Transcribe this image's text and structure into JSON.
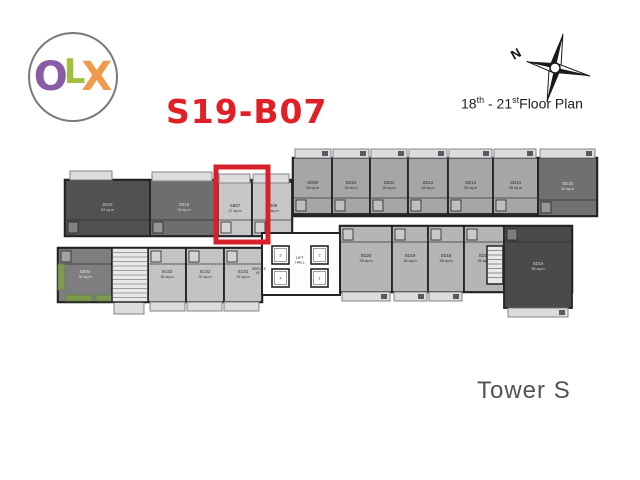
{
  "logo": {
    "letters": [
      {
        "ch": "O",
        "color": "#8a5ba6"
      },
      {
        "ch": "L",
        "color": "#a2c03c"
      },
      {
        "ch": "X",
        "color": "#f09a4b"
      }
    ]
  },
  "header": {
    "unit_code": "S19-B07",
    "unit_code_color": "#e01f26",
    "compass_n": "N",
    "floor_label": {
      "num1": "18",
      "sup1": "th",
      "sep": " - ",
      "num2": "21",
      "sup2": "st",
      "rest": "Floor Plan"
    }
  },
  "footer": {
    "tower": "Tower S",
    "color": "#515256"
  },
  "plan": {
    "wall": "#232325",
    "balcony_fill": "#dcdcde",
    "balcony_stroke": "#85858a",
    "ac_fill": "#5a5a5e",
    "planter_color": "#7d9b50",
    "highlight": {
      "x": 216,
      "y": 167,
      "w": 52,
      "h": 75,
      "color": "#d8202a",
      "stroke": 5
    },
    "bands": [
      {
        "x": 65,
        "y": 180,
        "w": 227,
        "h": 56,
        "fill": "#9a9a9c"
      },
      {
        "x": 293,
        "y": 158,
        "w": 304,
        "h": 58,
        "fill": "#a9a9ab"
      },
      {
        "x": 58,
        "y": 248,
        "w": 204,
        "h": 54,
        "fill": "#bdbdbf"
      },
      {
        "x": 340,
        "y": 226,
        "w": 232,
        "h": 66,
        "fill": "#b3b3b5"
      }
    ],
    "units": [
      {
        "id": "S016",
        "area": "54 sq.m",
        "x": 65,
        "y": 180,
        "w": 85,
        "h": 56,
        "fill": "#515154",
        "tc": "#d2d2d2",
        "b": "tl"
      },
      {
        "id": "S018",
        "area": "34 sq.m",
        "x": 150,
        "y": 180,
        "w": 68,
        "h": 56,
        "fill": "#6e6e71",
        "tc": "#dedede",
        "b": "tl"
      },
      {
        "id": "SB07",
        "area": "27 sq.m",
        "x": 218,
        "y": 182,
        "w": 34,
        "h": 54,
        "fill": "#c7c7c9",
        "tc": "#2e2e2e",
        "b": "tl"
      },
      {
        "id": "SB08",
        "area": "27 sq.m",
        "x": 252,
        "y": 182,
        "w": 40,
        "h": 54,
        "fill": "#c7c7c9",
        "tc": "#2e2e2e",
        "b": "tl"
      },
      {
        "id": "SD09",
        "area": "26 sq.m",
        "x": 293,
        "y": 158,
        "w": 39,
        "h": 56,
        "fill": "#a6a6a8",
        "tc": "#28282c",
        "b": "tr"
      },
      {
        "id": "SD10",
        "area": "26 sq.m",
        "x": 332,
        "y": 158,
        "w": 38,
        "h": 56,
        "fill": "#a6a6a8",
        "tc": "#28282c",
        "b": "tr"
      },
      {
        "id": "SD11",
        "area": "26 sq.m",
        "x": 370,
        "y": 158,
        "w": 38,
        "h": 56,
        "fill": "#a6a6a8",
        "tc": "#28282c",
        "b": "tr"
      },
      {
        "id": "SD12",
        "area": "26 sq.m",
        "x": 408,
        "y": 158,
        "w": 40,
        "h": 56,
        "fill": "#a6a6a8",
        "tc": "#28282c",
        "b": "tr"
      },
      {
        "id": "SD13",
        "area": "26 sq.m",
        "x": 448,
        "y": 158,
        "w": 45,
        "h": 56,
        "fill": "#a6a6a8",
        "tc": "#28282c",
        "b": "tr"
      },
      {
        "id": "SD14",
        "area": "26 sq.m",
        "x": 493,
        "y": 158,
        "w": 45,
        "h": 56,
        "fill": "#a6a6a8",
        "tc": "#28282c",
        "b": "tr"
      },
      {
        "id": "SD15",
        "area": "34 sq.m",
        "x": 538,
        "y": 158,
        "w": 59,
        "h": 58,
        "fill": "#707073",
        "tc": "#e6e6e6",
        "b": "tr"
      },
      {
        "id": "SE04",
        "area": "34 sq.m",
        "x": 58,
        "y": 248,
        "w": 54,
        "h": 54,
        "fill": "#7e7e81",
        "tc": "#e6e6e6",
        "b": "bl"
      },
      {
        "id": "SC03",
        "area": "36 sq.m",
        "x": 148,
        "y": 248,
        "w": 38,
        "h": 54,
        "fill": "#c3c3c5",
        "tc": "#2e2e2e",
        "b": "bl"
      },
      {
        "id": "SC02",
        "area": "32 sq.m",
        "x": 186,
        "y": 248,
        "w": 38,
        "h": 54,
        "fill": "#c3c3c5",
        "tc": "#2e2e2e",
        "b": "bl"
      },
      {
        "id": "SC01",
        "area": "32 sq.m",
        "x": 224,
        "y": 248,
        "w": 38,
        "h": 54,
        "fill": "#c3c3c5",
        "tc": "#2e2e2e",
        "b": "bl"
      },
      {
        "id": "SD20",
        "area": "26 sq.m",
        "x": 340,
        "y": 226,
        "w": 52,
        "h": 66,
        "fill": "#b5b5b7",
        "tc": "#28282c",
        "b": "br"
      },
      {
        "id": "SD19",
        "area": "26 sq.m",
        "x": 392,
        "y": 226,
        "w": 36,
        "h": 66,
        "fill": "#b5b5b7",
        "tc": "#28282c",
        "b": "br"
      },
      {
        "id": "SD18",
        "area": "26 sq.m",
        "x": 428,
        "y": 226,
        "w": 36,
        "h": 66,
        "fill": "#b5b5b7",
        "tc": "#28282c",
        "b": "br"
      },
      {
        "id": "SD17",
        "area": "26 sq.m",
        "x": 464,
        "y": 226,
        "w": 40,
        "h": 66,
        "fill": "#b5b5b7",
        "tc": "#28282c",
        "b": "br"
      },
      {
        "id": "SD16",
        "area": "55 sq.m",
        "x": 504,
        "y": 226,
        "w": 68,
        "h": 82,
        "fill": "#4a4a4d",
        "tc": "#d6d6d6",
        "b": "br"
      }
    ],
    "balconies": [
      {
        "x": 70,
        "y": 171,
        "w": 42,
        "h": 9,
        "ac": false
      },
      {
        "x": 152,
        "y": 172,
        "w": 60,
        "h": 9,
        "ac": false
      },
      {
        "x": 219,
        "y": 174,
        "w": 31,
        "h": 9,
        "ac": false
      },
      {
        "x": 253,
        "y": 174,
        "w": 36,
        "h": 9,
        "ac": false
      },
      {
        "x": 295,
        "y": 149,
        "w": 36,
        "h": 9,
        "ac": true
      },
      {
        "x": 333,
        "y": 149,
        "w": 36,
        "h": 9,
        "ac": true
      },
      {
        "x": 371,
        "y": 149,
        "w": 36,
        "h": 9,
        "ac": true
      },
      {
        "x": 409,
        "y": 149,
        "w": 38,
        "h": 9,
        "ac": true
      },
      {
        "x": 449,
        "y": 149,
        "w": 43,
        "h": 9,
        "ac": true
      },
      {
        "x": 494,
        "y": 149,
        "w": 42,
        "h": 9,
        "ac": true
      },
      {
        "x": 540,
        "y": 149,
        "w": 55,
        "h": 9,
        "ac": true
      },
      {
        "x": 114,
        "y": 302,
        "w": 30,
        "h": 12,
        "ac": false
      },
      {
        "x": 150,
        "y": 302,
        "w": 35,
        "h": 9,
        "ac": false
      },
      {
        "x": 187,
        "y": 302,
        "w": 35,
        "h": 9,
        "ac": false
      },
      {
        "x": 224,
        "y": 302,
        "w": 35,
        "h": 9,
        "ac": false
      },
      {
        "x": 342,
        "y": 292,
        "w": 48,
        "h": 9,
        "ac": true
      },
      {
        "x": 394,
        "y": 292,
        "w": 33,
        "h": 9,
        "ac": true
      },
      {
        "x": 429,
        "y": 292,
        "w": 33,
        "h": 9,
        "ac": true
      },
      {
        "x": 508,
        "y": 308,
        "w": 60,
        "h": 9,
        "ac": true
      }
    ],
    "planters": [
      {
        "x": 58,
        "y": 264,
        "w": 7,
        "h": 26
      },
      {
        "x": 66,
        "y": 295,
        "w": 26,
        "h": 6
      },
      {
        "x": 96,
        "y": 295,
        "w": 16,
        "h": 6
      }
    ],
    "stairs": [
      {
        "x": 112,
        "y": 248,
        "w": 36,
        "h": 54
      },
      {
        "x": 487,
        "y": 246,
        "w": 16,
        "h": 38
      }
    ],
    "lift_lobby": {
      "x": 262,
      "y": 233,
      "w": 78,
      "h": 62
    },
    "lifts": [
      {
        "n": "3",
        "x": 272,
        "y": 246,
        "w": 17,
        "h": 18
      },
      {
        "n": "2",
        "x": 311,
        "y": 246,
        "w": 17,
        "h": 18
      },
      {
        "n": "4",
        "x": 272,
        "y": 269,
        "w": 17,
        "h": 18
      },
      {
        "n": "1",
        "x": 311,
        "y": 269,
        "w": 17,
        "h": 18
      }
    ],
    "plan_labels": [
      {
        "text": "LIFT\nHALL",
        "x": 300,
        "y": 259,
        "size": 3.8
      },
      {
        "text": "SERVICE\nLIFT",
        "x": 259,
        "y": 270,
        "size": 3.2
      }
    ]
  }
}
